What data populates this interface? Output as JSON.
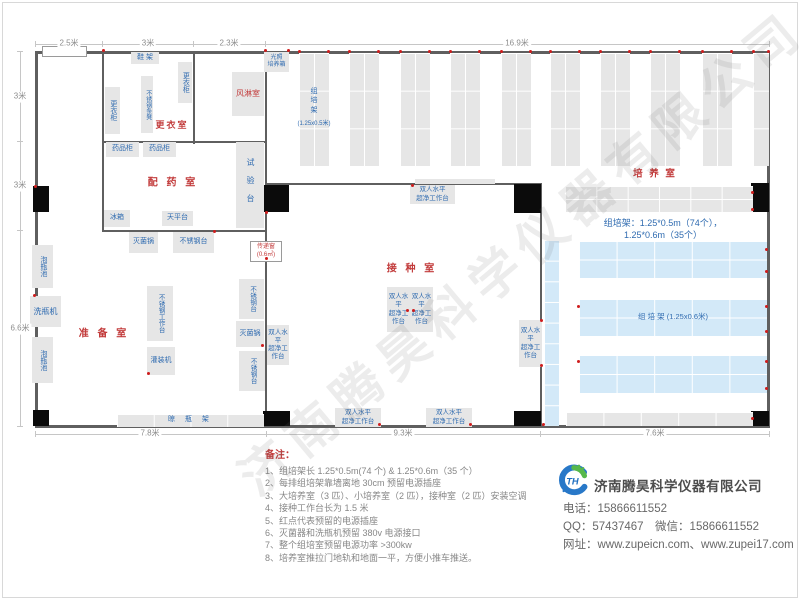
{
  "watermark": "济南腾昊科学仪器有限公司",
  "colors": {
    "wall": "#5f5f5f",
    "equipment_fill": "#e6e6e6",
    "blue_rack_fill": "#d3e9f8",
    "room_label": "#c23b3b",
    "equipment_text": "#2f6bb0",
    "outlet_dot": "#cf1d1d",
    "dim_text": "#8c8c8c",
    "note_text": "#878787"
  },
  "plan": {
    "walls": [
      [
        35,
        51,
        735,
        3
      ],
      [
        35,
        425,
        735,
        3
      ],
      [
        35,
        51,
        3,
        377
      ],
      [
        767,
        51,
        3,
        377
      ],
      [
        102,
        51,
        2,
        181
      ],
      [
        193,
        51,
        2,
        93
      ],
      [
        265,
        51,
        2,
        377
      ],
      [
        102,
        141,
        165,
        2
      ],
      [
        102,
        230,
        165,
        2
      ],
      [
        265,
        183,
        277,
        2
      ],
      [
        540,
        183,
        2,
        245
      ]
    ],
    "dim_lines": [
      [
        35,
        44,
        735,
        1
      ],
      [
        35,
        41,
        1,
        6
      ],
      [
        102,
        41,
        1,
        6
      ],
      [
        193,
        41,
        1,
        6
      ],
      [
        265,
        41,
        1,
        6
      ],
      [
        769,
        41,
        1,
        6
      ],
      [
        20,
        52,
        1,
        375
      ],
      [
        17,
        51,
        6,
        1
      ],
      [
        17,
        141,
        6,
        1
      ],
      [
        17,
        230,
        6,
        1
      ],
      [
        17,
        426,
        6,
        1
      ],
      [
        35,
        434,
        735,
        1
      ],
      [
        35,
        431,
        1,
        6
      ],
      [
        266,
        431,
        1,
        6
      ],
      [
        540,
        431,
        1,
        6
      ],
      [
        769,
        431,
        1,
        6
      ]
    ],
    "doors": [
      [
        33,
        186,
        16,
        26
      ],
      [
        33,
        410,
        16,
        16
      ],
      [
        261,
        185,
        28,
        27
      ],
      [
        514,
        184,
        27,
        29
      ],
      [
        751,
        183,
        18,
        29
      ],
      [
        263,
        411,
        27,
        15
      ],
      [
        514,
        411,
        27,
        15
      ],
      [
        751,
        411,
        18,
        15
      ]
    ],
    "racks": [
      {
        "x": 299,
        "y": 53,
        "w": 30,
        "h": 113,
        "c": 2,
        "r": 3
      },
      {
        "x": 349,
        "y": 53,
        "w": 30,
        "h": 113,
        "c": 2,
        "r": 3
      },
      {
        "x": 400,
        "y": 53,
        "w": 30,
        "h": 113,
        "c": 2,
        "r": 3
      },
      {
        "x": 450,
        "y": 53,
        "w": 30,
        "h": 113,
        "c": 2,
        "r": 3
      },
      {
        "x": 501,
        "y": 53,
        "w": 30,
        "h": 113,
        "c": 2,
        "r": 3
      },
      {
        "x": 550,
        "y": 53,
        "w": 30,
        "h": 113,
        "c": 2,
        "r": 3
      },
      {
        "x": 600,
        "y": 53,
        "w": 30,
        "h": 113,
        "c": 2,
        "r": 3
      },
      {
        "x": 650,
        "y": 53,
        "w": 30,
        "h": 113,
        "c": 2,
        "r": 3
      },
      {
        "x": 702,
        "y": 53,
        "w": 30,
        "h": 113,
        "c": 2,
        "r": 3
      },
      {
        "x": 753,
        "y": 53,
        "w": 16,
        "h": 113,
        "c": 1,
        "r": 3
      },
      {
        "x": 565,
        "y": 186,
        "w": 188,
        "h": 26,
        "c": 6,
        "r": 2
      },
      {
        "x": 415,
        "y": 179,
        "w": 80,
        "h": 5,
        "c": 1,
        "r": 1
      },
      {
        "x": 544,
        "y": 240,
        "w": 15,
        "h": 186,
        "c": 1,
        "r": 9,
        "blue": 1
      },
      {
        "x": 579,
        "y": 241,
        "w": 188,
        "h": 37,
        "c": 5,
        "r": 2,
        "blue": 1
      },
      {
        "x": 579,
        "y": 299,
        "w": 188,
        "h": 37,
        "c": 5,
        "r": 2,
        "blue": 1
      },
      {
        "x": 579,
        "y": 355,
        "w": 188,
        "h": 38,
        "c": 5,
        "r": 2,
        "blue": 1
      },
      {
        "x": 566,
        "y": 412,
        "w": 187,
        "h": 14,
        "c": 5,
        "r": 1
      }
    ],
    "equipment": [
      {
        "t": "鞋 架",
        "x": 131,
        "y": 52,
        "w": 28,
        "h": 12
      },
      {
        "t": "更衣柜",
        "x": 178,
        "y": 62,
        "w": 14,
        "h": 41,
        "v": 1
      },
      {
        "t": "不锈钢条凳",
        "x": 141,
        "y": 76,
        "w": 12,
        "h": 57,
        "v": 1,
        "fs": 6
      },
      {
        "t": "更衣柜",
        "x": 105,
        "y": 87,
        "w": 15,
        "h": 47,
        "v": 1
      },
      {
        "t": "风淋室",
        "x": 232,
        "y": 72,
        "w": 32,
        "h": 44,
        "red": 1,
        "fs": 8
      },
      {
        "t": "光照\n培养箱",
        "x": 264,
        "y": 52,
        "w": 25,
        "h": 20,
        "fs": 6
      },
      {
        "t": "药品柜",
        "x": 106,
        "y": 142,
        "w": 33,
        "h": 15
      },
      {
        "t": "药品柜",
        "x": 143,
        "y": 142,
        "w": 33,
        "h": 15
      },
      {
        "t": "试验台",
        "x": 236,
        "y": 142,
        "w": 28,
        "h": 86,
        "v": 1,
        "fs": 8,
        "ls": 10
      },
      {
        "t": "冰箱",
        "x": 104,
        "y": 210,
        "w": 26,
        "h": 17
      },
      {
        "t": "天平台",
        "x": 162,
        "y": 211,
        "w": 31,
        "h": 15
      },
      {
        "t": "灭菌锅",
        "x": 129,
        "y": 232,
        "w": 29,
        "h": 21
      },
      {
        "t": "不锈钢台",
        "x": 173,
        "y": 232,
        "w": 41,
        "h": 21
      },
      {
        "t": "泡瓶池",
        "x": 32,
        "y": 245,
        "w": 21,
        "h": 43,
        "v": 1
      },
      {
        "t": "洗瓶机",
        "x": 30,
        "y": 296,
        "w": 31,
        "h": 31,
        "fs": 8
      },
      {
        "t": "泡瓶池",
        "x": 32,
        "y": 337,
        "w": 21,
        "h": 46,
        "v": 1
      },
      {
        "t": "不锈钢工作台",
        "x": 147,
        "y": 286,
        "w": 26,
        "h": 55,
        "v": 1,
        "fs": 6.5
      },
      {
        "t": "灌装机",
        "x": 147,
        "y": 347,
        "w": 28,
        "h": 28
      },
      {
        "t": "不锈钢台",
        "x": 239,
        "y": 279,
        "w": 25,
        "h": 40,
        "v": 1,
        "fs": 6.5
      },
      {
        "t": "灭菌锅",
        "x": 236,
        "y": 321,
        "w": 28,
        "h": 26
      },
      {
        "t": "不锈钢台",
        "x": 239,
        "y": 351,
        "w": 26,
        "h": 40,
        "v": 1,
        "fs": 6.5
      },
      {
        "t": "晾  瓶  架",
        "x": 117,
        "y": 414,
        "w": 147,
        "h": 13,
        "grid": [
          4,
          1
        ],
        "ls": 4
      },
      {
        "t": "双人水平\n超净工作台",
        "x": 410,
        "y": 185,
        "w": 45,
        "h": 19,
        "fs": 6.5
      },
      {
        "t": "双人水平\n超净工作台",
        "x": 387,
        "y": 287,
        "w": 23,
        "h": 45,
        "fs": 6.5
      },
      {
        "t": "双人水平\n超净工作台",
        "x": 410,
        "y": 287,
        "w": 23,
        "h": 45,
        "fs": 6.5
      },
      {
        "t": "双人水平\n超净工作台",
        "x": 267,
        "y": 325,
        "w": 22,
        "h": 40,
        "fs": 6.5
      },
      {
        "t": "双人水平\n超净工作台",
        "x": 519,
        "y": 320,
        "w": 23,
        "h": 47,
        "fs": 6.5
      },
      {
        "t": "双人水平\n超净工作台",
        "x": 335,
        "y": 408,
        "w": 46,
        "h": 19,
        "fs": 6.5
      },
      {
        "t": "双人水平\n超净工作台",
        "x": 426,
        "y": 408,
        "w": 46,
        "h": 19,
        "fs": 6.5
      },
      {
        "t": "传递窗\n(0.6㎡)",
        "x": 250,
        "y": 241,
        "w": 30,
        "h": 19,
        "cls": "white",
        "red": 1,
        "fs": 6
      },
      {
        "t": "",
        "x": 42,
        "y": 46,
        "w": 43,
        "h": 9,
        "cls": "white"
      }
    ],
    "texts": [
      {
        "n": "room-label-dressing",
        "t": "更衣室",
        "x": 172,
        "y": 125,
        "fs": 9,
        "c": "red",
        "ls": 2
      },
      {
        "n": "room-label-pharmacy",
        "t": "配 药 室",
        "x": 173,
        "y": 183,
        "fs": 10,
        "c": "red",
        "ls": 3
      },
      {
        "n": "room-label-preparation",
        "t": "准 备 室",
        "x": 104,
        "y": 334,
        "fs": 10,
        "c": "red",
        "ls": 3
      },
      {
        "n": "room-label-inoculation",
        "t": "接 种 室",
        "x": 412,
        "y": 269,
        "fs": 10,
        "c": "red",
        "ls": 3
      },
      {
        "n": "room-label-culture",
        "t": "培 养 室",
        "x": 655,
        "y": 175,
        "fs": 9.5,
        "c": "red",
        "ls": 2
      },
      {
        "n": "rack-label-small",
        "t": "组\n培\n架",
        "x": 314,
        "y": 101,
        "fs": 7,
        "c": "blue"
      },
      {
        "n": "rack-label-small-size",
        "t": "(1.25x0.5米)",
        "x": 314,
        "y": 124,
        "fs": 6,
        "c": "blue"
      },
      {
        "n": "rack-label-large",
        "t": "组  培  架 (1.25x0.6米)",
        "x": 673,
        "y": 317,
        "fs": 7.5,
        "c": "blue"
      },
      {
        "n": "rack-caption",
        "t": "组培架：1.25*0.5m（74个），1.25*0.6m（35个）",
        "x": 663,
        "y": 229,
        "fs": 9,
        "c": "blue"
      },
      {
        "n": "dim-top-1",
        "t": "2.5米",
        "x": 69,
        "y": 44,
        "fs": 8,
        "bg": 1
      },
      {
        "n": "dim-top-2",
        "t": "3米",
        "x": 148,
        "y": 44,
        "fs": 8,
        "bg": 1
      },
      {
        "n": "dim-top-3",
        "t": "2.3米",
        "x": 229,
        "y": 44,
        "fs": 8,
        "bg": 1
      },
      {
        "n": "dim-top-4",
        "t": "16.9米",
        "x": 517,
        "y": 44,
        "fs": 8,
        "bg": 1
      },
      {
        "n": "dim-left-1",
        "t": "3米",
        "x": 20,
        "y": 97,
        "fs": 8,
        "bg": 1
      },
      {
        "n": "dim-left-2",
        "t": "3米",
        "x": 20,
        "y": 186,
        "fs": 8,
        "bg": 1
      },
      {
        "n": "dim-left-3",
        "t": "6.6米",
        "x": 20,
        "y": 329,
        "fs": 8,
        "bg": 1
      },
      {
        "n": "dim-bottom-1",
        "t": "7.8米",
        "x": 150,
        "y": 434,
        "fs": 8,
        "bg": 1
      },
      {
        "n": "dim-bottom-2",
        "t": "9.3米",
        "x": 403,
        "y": 434,
        "fs": 8,
        "bg": 1
      },
      {
        "n": "dim-bottom-3",
        "t": "7.6米",
        "x": 655,
        "y": 434,
        "fs": 8,
        "bg": 1
      }
    ],
    "dots": [
      [
        288,
        50
      ],
      [
        103,
        50
      ],
      [
        265,
        50
      ],
      [
        35,
        186
      ],
      [
        266,
        212
      ],
      [
        266,
        258
      ],
      [
        34,
        295
      ],
      [
        148,
        373
      ],
      [
        262,
        345
      ],
      [
        214,
        231
      ],
      [
        412,
        185
      ],
      [
        407,
        310
      ],
      [
        413,
        310
      ],
      [
        379,
        424
      ],
      [
        470,
        424
      ],
      [
        541,
        320
      ],
      [
        541,
        365
      ],
      [
        543,
        424
      ],
      [
        752,
        192
      ],
      [
        752,
        209
      ],
      [
        766,
        249
      ],
      [
        766,
        271
      ],
      [
        578,
        306
      ],
      [
        766,
        306
      ],
      [
        766,
        331
      ],
      [
        578,
        361
      ],
      [
        766,
        361
      ],
      [
        766,
        388
      ],
      [
        752,
        418
      ]
    ]
  },
  "notes": {
    "title": "备注：",
    "items": [
      "1、组培架长 1.25*0.5m(74 个) & 1.25*0.6m（35 个）",
      "2、每排组培架靠墙离地 30cm 预留电源插座",
      "3、大培养室（3 匹）、小培养室（2 匹），接种室（2 匹）安装空调",
      "4、接种工作台长为 1.5 米",
      "5、红点代表预留的电源插座",
      "6、灭菌器和洗瓶机预留 380v 电源接口",
      "7、整个组培室预留电源功率 >300kw",
      "8、培养室推拉门地轨和地面一平，方便小推车推送。"
    ]
  },
  "company": {
    "name": "济南腾昊科学仪器有限公司",
    "contact_lines": [
      "电话：15866611552",
      "QQ：57437467　微信：15866611552",
      "网址：www.zupeicn.com、www.zupei17.com"
    ]
  }
}
